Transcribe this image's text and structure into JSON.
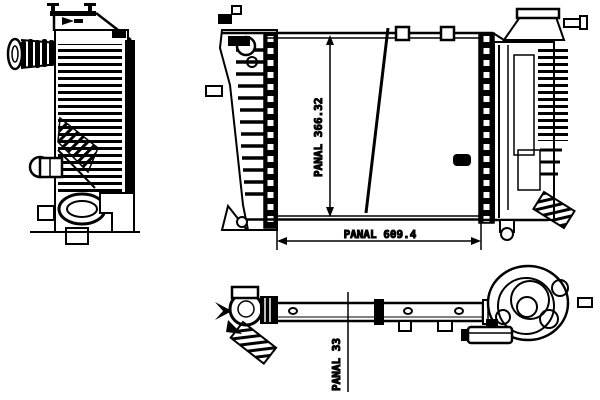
{
  "drawing": {
    "ink_color": "#000000",
    "background_color": "#ffffff",
    "dimensions": {
      "panel_height": {
        "label": "PANAL 366.32",
        "orientation": "vertical"
      },
      "panel_width": {
        "label": "PANAL 609.4",
        "orientation": "horizontal"
      },
      "panel_depth": {
        "label": "PANAL 33",
        "orientation": "vertical"
      }
    }
  }
}
